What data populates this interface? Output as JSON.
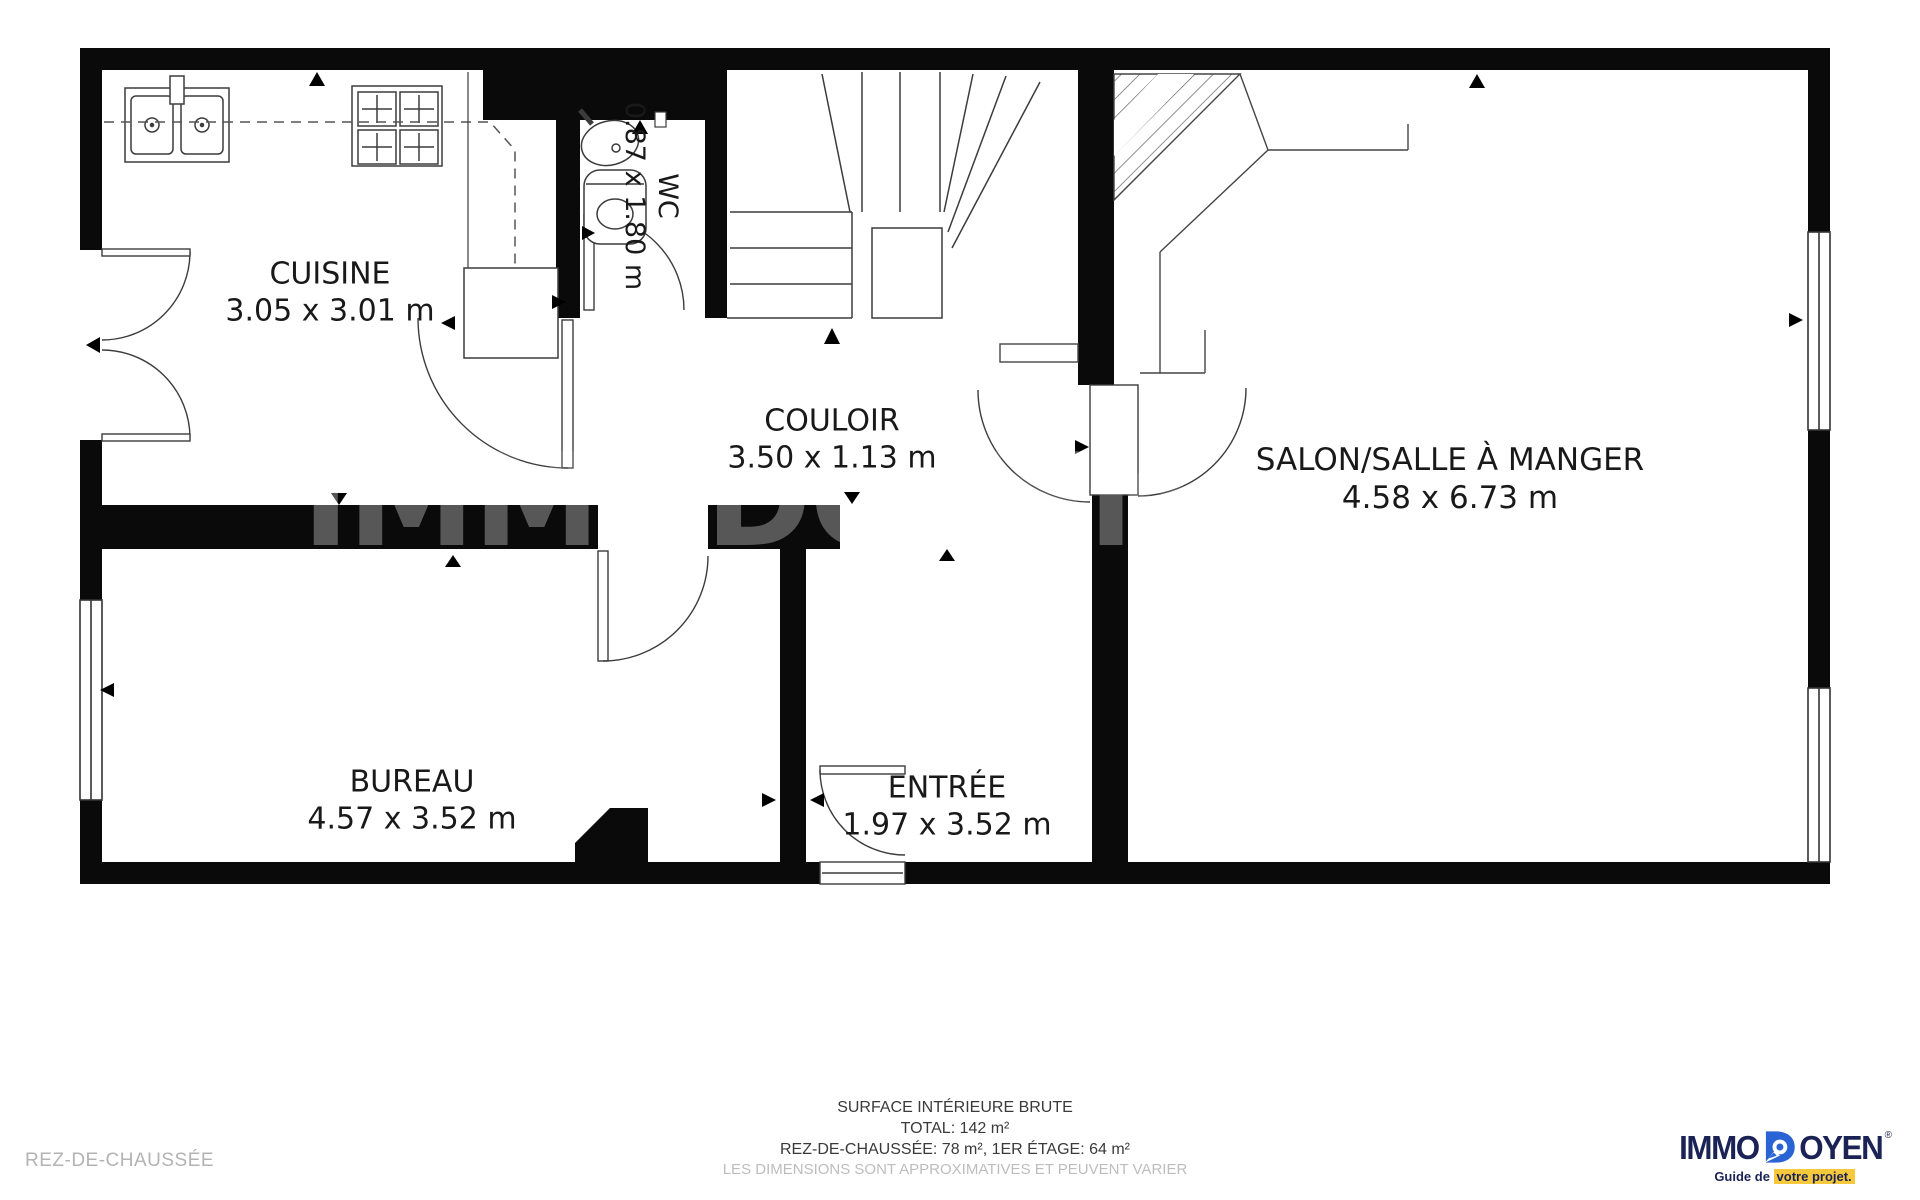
{
  "plan": {
    "floor_label": "REZ-DE-CHAUSSÉE",
    "watermark": "IMMODOYEN",
    "rooms": [
      {
        "id": "cuisine",
        "name": "CUISINE",
        "dimensions": "3.05 x 3.01 m"
      },
      {
        "id": "wc",
        "name": "WC",
        "dimensions": "0.87 x 1.80 m"
      },
      {
        "id": "couloir",
        "name": "COULOIR",
        "dimensions": "3.50 x 1.13 m"
      },
      {
        "id": "salon",
        "name": "SALON/SALLE À MANGER",
        "dimensions": "4.58 x 6.73 m"
      },
      {
        "id": "bureau",
        "name": "BUREAU",
        "dimensions": "4.57 x 3.52 m"
      },
      {
        "id": "entree",
        "name": "ENTRÉE",
        "dimensions": "1.97 x 3.52 m"
      }
    ]
  },
  "footer": {
    "line1": "SURFACE INTÉRIEURE BRUTE",
    "line2": "TOTAL: 142 m²",
    "line3": "REZ-DE-CHAUSSÉE: 78 m², 1ER ÉTAGE: 64 m²",
    "line4": "LES DIMENSIONS SONT APPROXIMATIVES ET PEUVENT VARIER"
  },
  "logo": {
    "brand_left": "IMMO",
    "brand_right": "OYEN",
    "registered": "®",
    "tagline_prefix": "Guide de ",
    "tagline_highlight": "votre projet.",
    "colors": {
      "navy": "#1b2356",
      "blue": "#2a63d4",
      "yellow": "#f6c93c"
    }
  }
}
